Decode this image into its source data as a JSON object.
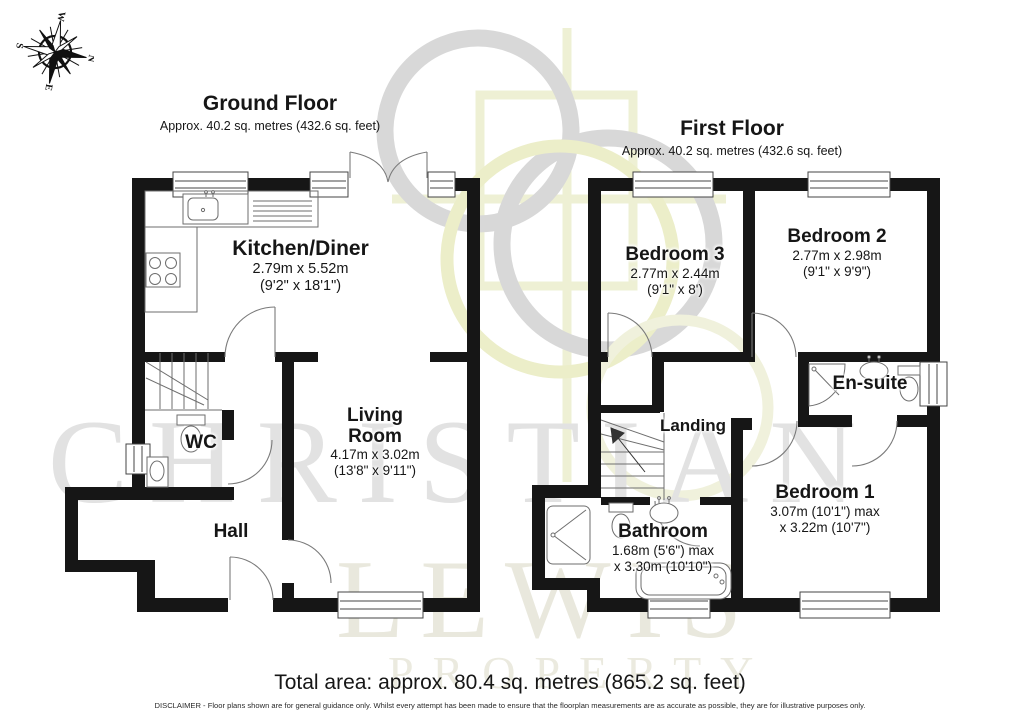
{
  "compass": {
    "n": "N",
    "e": "E",
    "s": "S",
    "w": "W"
  },
  "watermark": {
    "line1": "CHRISTIAN",
    "line2": "LEWIS",
    "line3": "PROPERTY"
  },
  "ground_floor": {
    "title": "Ground Floor",
    "area": "Approx. 40.2 sq. metres (432.6 sq. feet)",
    "rooms": {
      "kitchen": {
        "name": "Kitchen/Diner",
        "metric": "2.79m x 5.52m",
        "imperial": "(9'2\" x 18'1\")"
      },
      "living": {
        "name": "Living Room",
        "metric": "4.17m x 3.02m",
        "imperial": "(13'8\" x 9'11\")"
      },
      "wc": {
        "name": "WC"
      },
      "hall": {
        "name": "Hall"
      }
    }
  },
  "first_floor": {
    "title": "First Floor",
    "area": "Approx. 40.2 sq. metres (432.6 sq. feet)",
    "rooms": {
      "bedroom3": {
        "name": "Bedroom 3",
        "metric": "2.77m x 2.44m",
        "imperial": "(9'1\" x 8')"
      },
      "bedroom2": {
        "name": "Bedroom 2",
        "metric": "2.77m x 2.98m",
        "imperial": "(9'1\" x 9'9\")"
      },
      "ensuite": {
        "name": "En-suite"
      },
      "landing": {
        "name": "Landing"
      },
      "bathroom": {
        "name": "Bathroom",
        "metric": "1.68m (5'6\") max",
        "imperial": "x 3.30m (10'10\")"
      },
      "bedroom1": {
        "name": "Bedroom 1",
        "metric": "3.07m (10'1\") max",
        "imperial": "x 3.22m (10'7\")"
      }
    }
  },
  "footer": {
    "total_area": "Total area: approx. 80.4 sq. metres (865.2 sq. feet)",
    "disclaimer": "DISCLAIMER -  Floor plans shown are for general guidance only. Whilst every attempt has been made to ensure that the floorplan measurements are as accurate as possible, they are for illustrative purposes only."
  },
  "colors": {
    "wall": "#161616",
    "fixture_line": "#777777",
    "watermark_gray": "#d8d8d8",
    "watermark_yellow": "#edefd2"
  }
}
